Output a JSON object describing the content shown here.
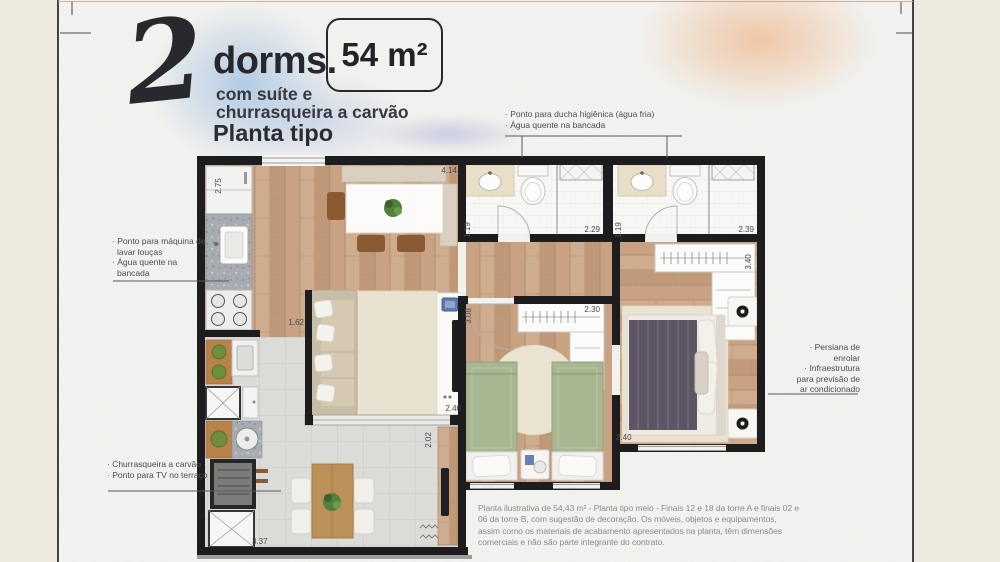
{
  "header": {
    "big_number": "2",
    "dorms": "dorms.",
    "subtitle_line1": "com suíte e",
    "subtitle_line2": "churrasqueira a carvão",
    "plan_type": "Planta tipo",
    "area_badge": "54 m²"
  },
  "callouts": {
    "kitchen": {
      "items": [
        "· Ponto para máquina de lavar louças",
        "· Água quente na bancada"
      ]
    },
    "bathrooms": {
      "items": [
        "· Ponto para ducha higiênica (água fria)",
        "· Água quente na bancada"
      ]
    },
    "suite": {
      "items": [
        "· Persiana de enrolar",
        "· Infraestrutura para previsão de ar condicionado"
      ]
    },
    "terrace": {
      "items": [
        "· Churrasqueira a carvão",
        "· Ponto para TV no terraço"
      ]
    }
  },
  "measurements": {
    "kitchen_depth": "2.75",
    "living_width": "4.14",
    "bath1_depth": "1.19",
    "bath1_width": "2.29",
    "bath2_depth": "1.19",
    "bath2_width": "2.39",
    "suite_closet_depth": "3.40",
    "bedroom2_closet_width": "2.30",
    "bedroom2_depth": "3.08",
    "sofa_wall_width": "1.62",
    "living_tv_width": "2.40",
    "suite_width": "2.40",
    "terrace_depth": "2.02",
    "terrace_width": "3.37"
  },
  "footer": {
    "disclaimer": "Planta ilustrativa de 54,43 m² - Planta tipo meio - Finais 12 e 18 da torre A e finais 02 e 06 da torre B, com sugestão de decoração. Os móveis, objetos e equipamentos, assim como os materiais de acabamento apresentados na planta, têm dimensões comerciais e não são parte integrante do contrato."
  },
  "palette": {
    "wall": "#1d1d1f",
    "wood_floor": "#c8a283",
    "terrace_tile": "#dbdbd7",
    "watercolor_blue": "#a3c4e3",
    "watercolor_peach": "#f2c49d",
    "ink": "#28272b",
    "bed_green": "#a9b692",
    "suite_blanket": "#5c5563"
  }
}
